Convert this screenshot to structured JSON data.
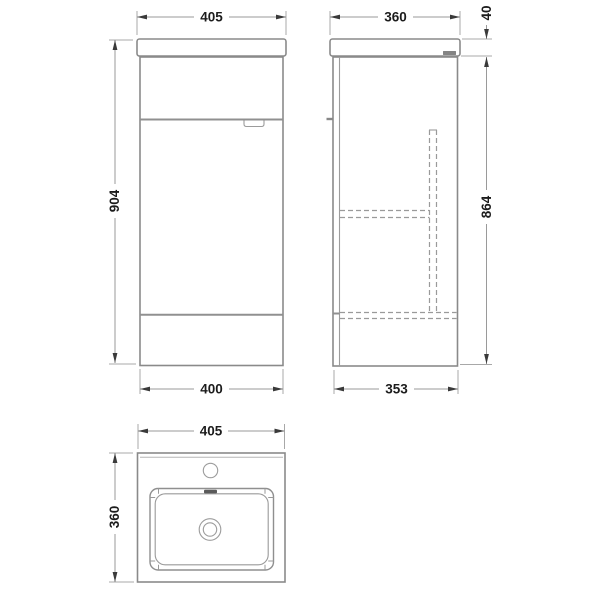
{
  "drawing": {
    "type": "bathroom-vanity-unit-technical-drawing",
    "units": "mm",
    "colors": {
      "background": "#ffffff",
      "outline_gray": "#8a8a8a",
      "dimension_line_gray": "#9a9a9a",
      "hidden_line_gray": "#9a9a9a",
      "text_black": "#1c1c1c",
      "overflow_slot_dark": "#5a5a5a",
      "stamp_gray": "#777777"
    },
    "views": {
      "front": {
        "label": "front-elevation",
        "top_width": "405",
        "height": "904",
        "bottom_width": "400"
      },
      "side": {
        "label": "side-elevation",
        "top_depth": "360",
        "worktop_thickness": "40",
        "body_height": "864",
        "bottom_depth": "353"
      },
      "plan": {
        "label": "plan-view-basin",
        "width": "405",
        "depth": "360"
      }
    }
  }
}
